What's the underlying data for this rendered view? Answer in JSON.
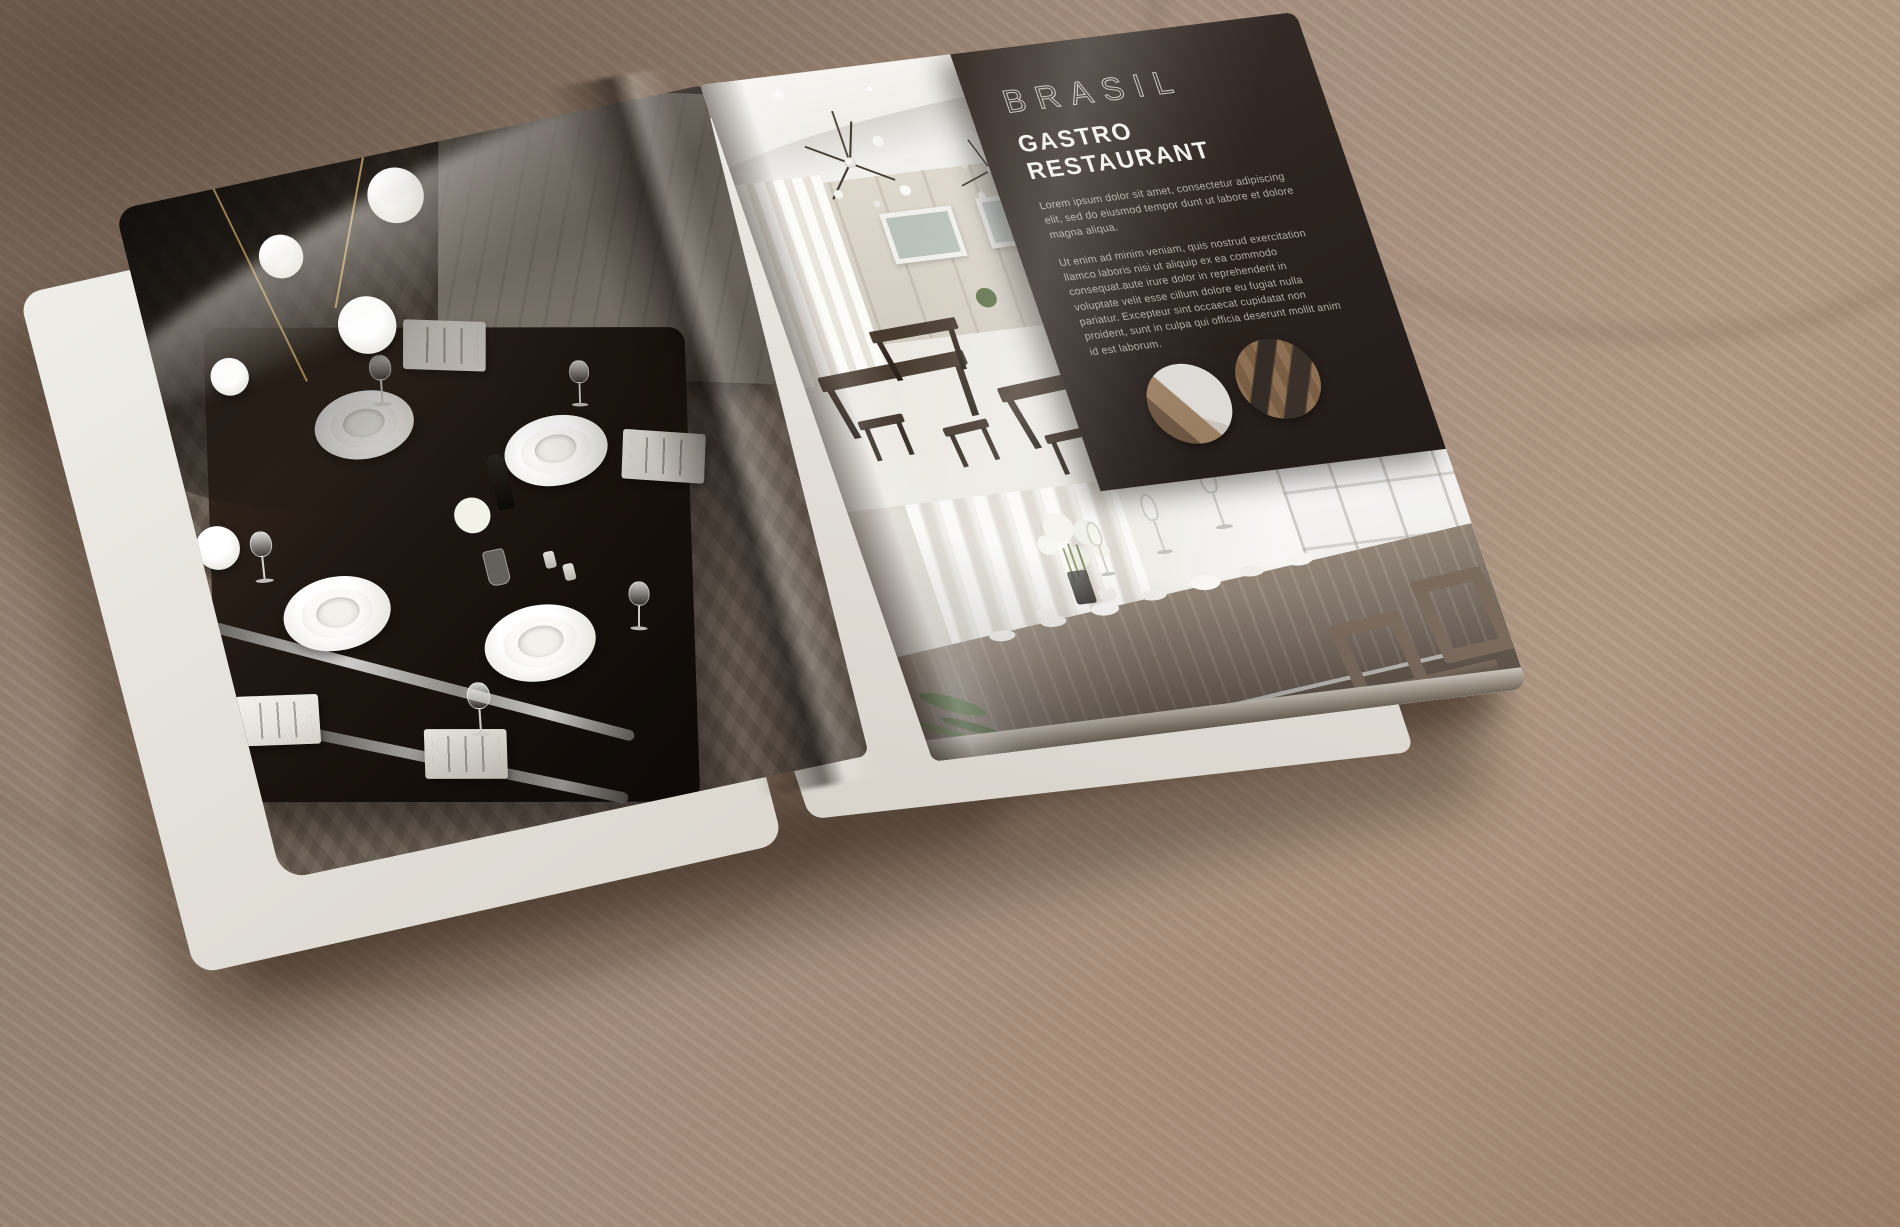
{
  "magazine": {
    "right_page": {
      "panel": {
        "kicker": "BRASIL",
        "title": "GASTRO RESTAURANT",
        "body_1": "Lorem ipsum dolor sit amet, consectetur adipiscing elit, sed do eiusmod tempor dunt ut labore et dolore magna aliqua.",
        "body_2": "Ut enim ad minim veniam, quis nostrud exercitation llamco laboris nisi ut aliquip ex ea commodo consequat.aute irure dolor in reprehenderit in voluptate velit esse cillum dolore eu fugiat nulla pariatur. Excepteur sint occaecat cupidatat non proident, sunt in culpa qui officia deserunt mollit anim id est laborum."
      }
    }
  },
  "colors": {
    "panel_background": "#2d2420",
    "panel_kicker": "#c8c3bd",
    "panel_title": "#f2f0ec",
    "panel_body": "#b2aca5",
    "desk_wood": "#a48c79",
    "ceiling_gold_trim": "#c4a96c"
  }
}
